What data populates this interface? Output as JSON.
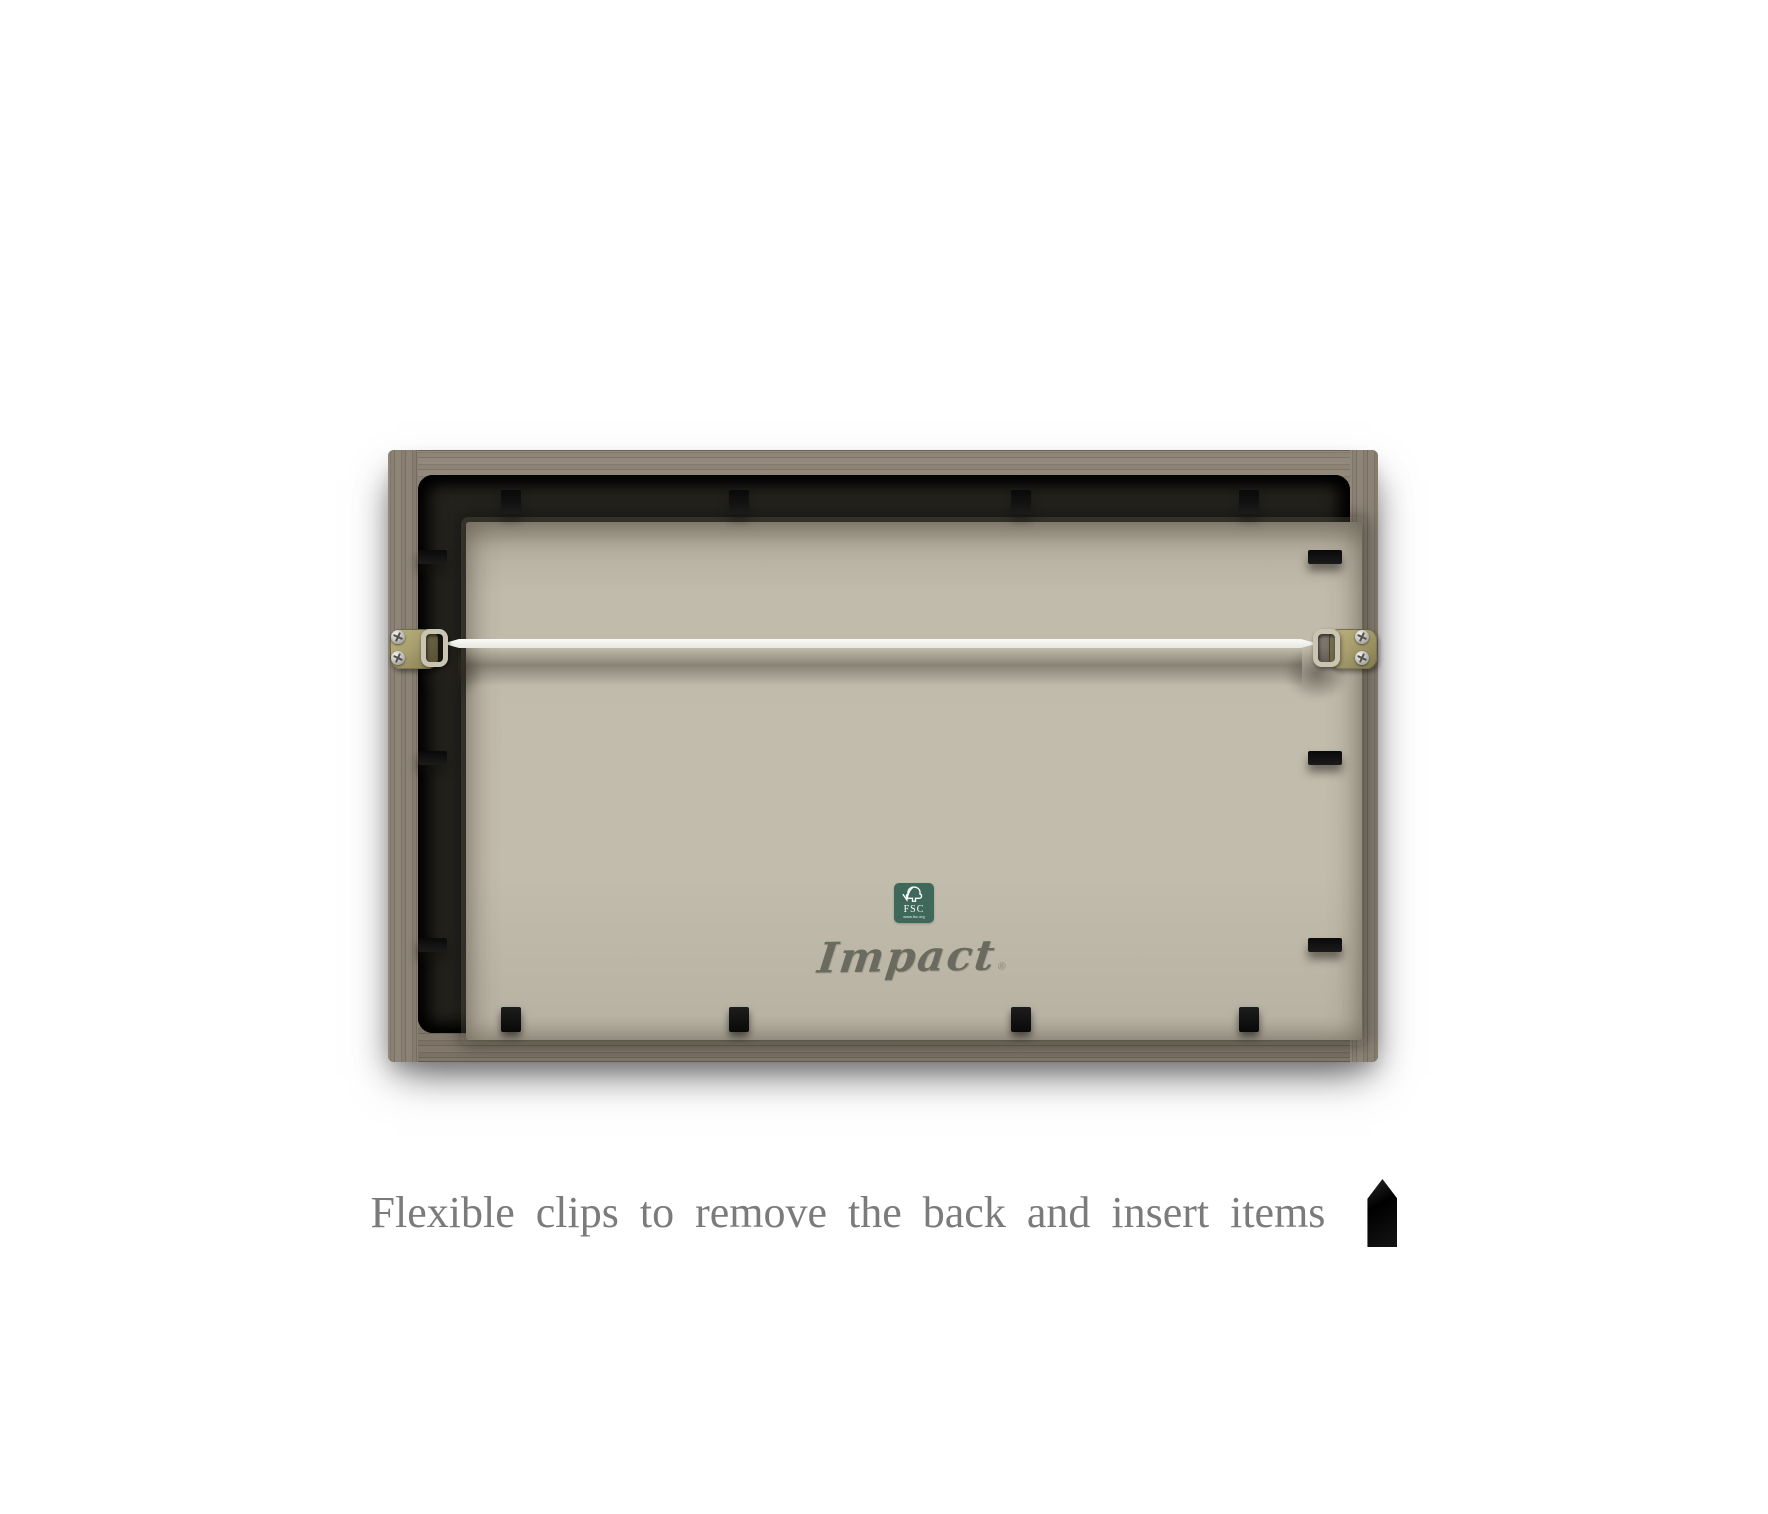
{
  "caption": {
    "text": "Flexible clips to remove the back and insert items",
    "color": "#7b7b7b"
  },
  "brand": {
    "name": "Impact",
    "trademark_symbol": "®",
    "color": "#6b6a5f"
  },
  "fsc_badge": {
    "abbr": "FSC",
    "website": "www.fsc.org",
    "background_color": "#3e685a",
    "icon": "fsc-tree-check-icon"
  },
  "frame": {
    "wood_color": "#877d70",
    "backing_board_color": "#c0baab",
    "inner_lip_color": "#23221d",
    "clip_color": "#0e0e0e",
    "wire_color": "#f2f2ee",
    "hanger_plate_color": "#a89e6e",
    "clip_counts": {
      "top": 4,
      "bottom": 4,
      "left": 3,
      "right": 3
    },
    "d_ring_hanger_count": 2,
    "hanging_wire_count": 1
  }
}
